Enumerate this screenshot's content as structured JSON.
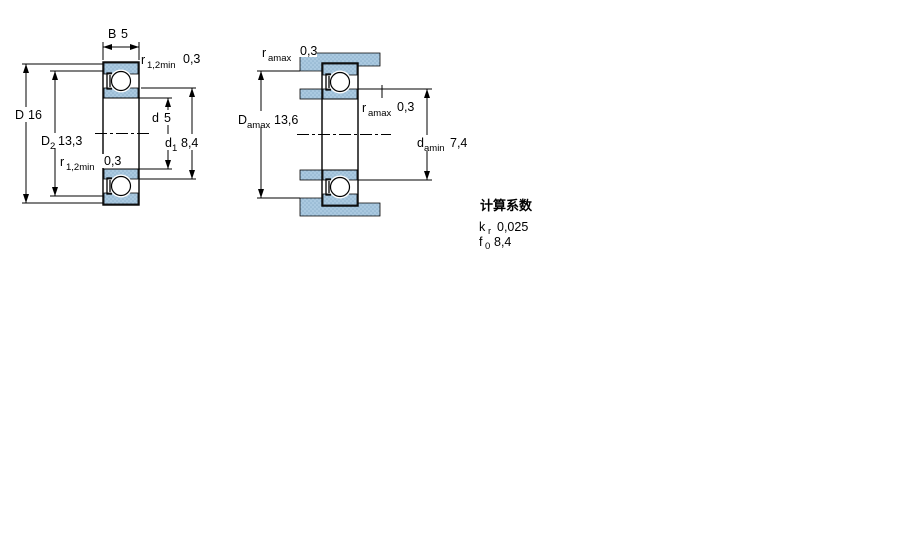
{
  "colors": {
    "steel_fill": "#aac9e0",
    "steel_dot": "#8db1cc",
    "line": "#000000",
    "background": "#ffffff"
  },
  "main_view": {
    "labels": {
      "width_b": {
        "symbol": "B",
        "value": "5"
      },
      "r12_top": {
        "symbol": "r",
        "sub": "1,2min",
        "value": "0,3"
      },
      "outer_d": {
        "symbol": "D",
        "value": "16"
      },
      "d2": {
        "symbol": "D",
        "sub": "2",
        "value": "13,3"
      },
      "r12_mid": {
        "symbol": "r",
        "sub": "1,2min",
        "value": "0,3"
      },
      "bore_d": {
        "symbol": "d",
        "value": "5"
      },
      "d1": {
        "symbol": "d",
        "sub": "1",
        "value": "8,4"
      }
    }
  },
  "abutment_view": {
    "labels": {
      "ra_top": {
        "symbol": "r",
        "sub": "amax",
        "value": "0,3"
      },
      "da_max": {
        "symbol": "D",
        "sub": "amax",
        "value": "13,6"
      },
      "ra_mid": {
        "symbol": "r",
        "sub": "amax",
        "value": "0,3"
      },
      "da_min": {
        "symbol": "d",
        "sub": "amin",
        "value": "7,4"
      }
    }
  },
  "calculation_factors": {
    "heading": "计算系数",
    "rows": [
      {
        "symbol": "k",
        "sub": "r",
        "value": "0,025"
      },
      {
        "symbol": "f",
        "sub": "0",
        "value": "8,4"
      }
    ]
  }
}
